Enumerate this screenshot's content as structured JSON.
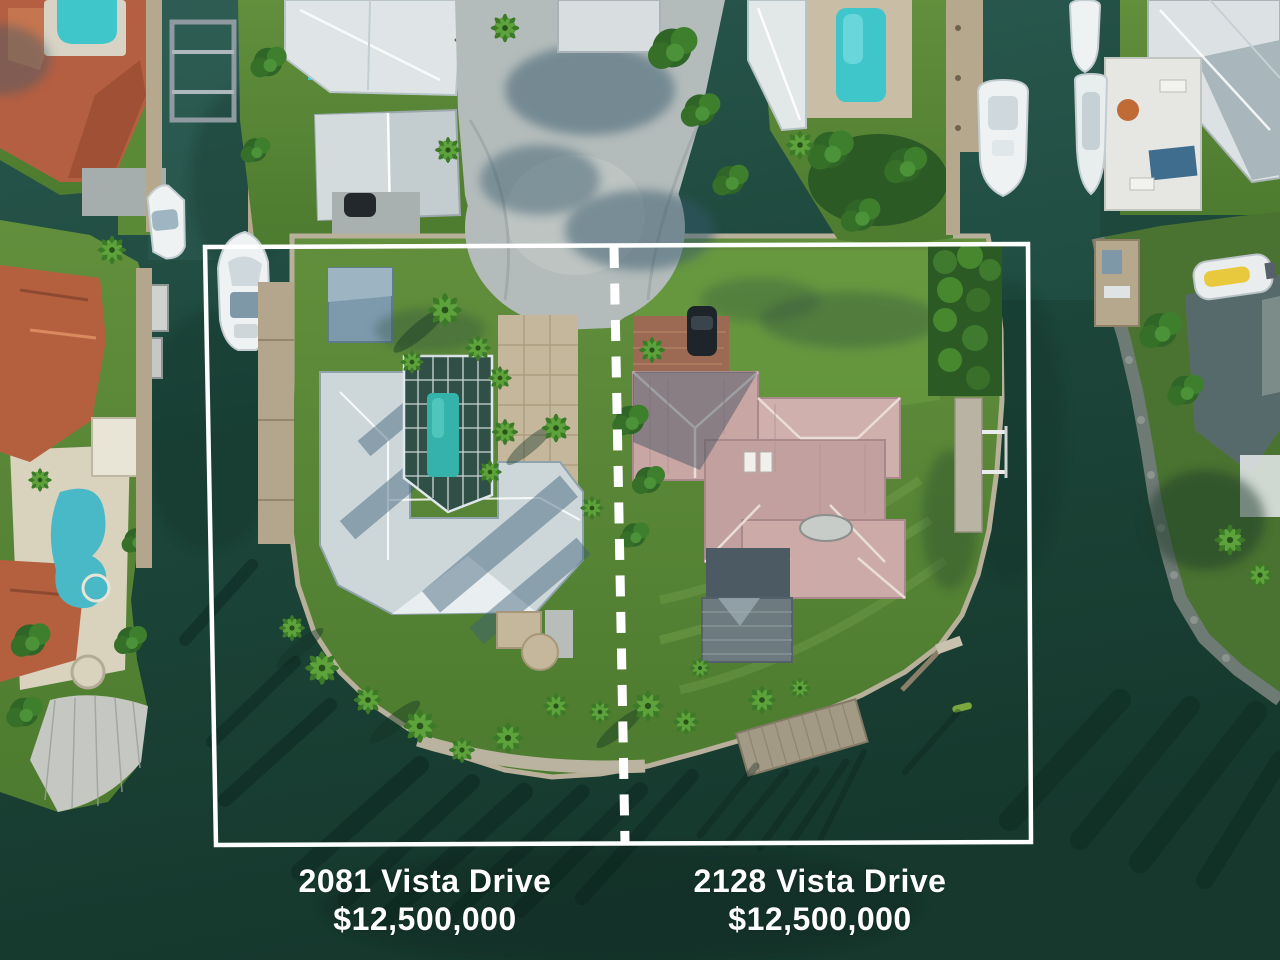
{
  "labels": {
    "left": {
      "address": "2081 Vista Drive",
      "price": "$12,500,000"
    },
    "right": {
      "address": "2128 Vista Drive",
      "price": "$12,500,000"
    }
  },
  "palette": {
    "overlay_white": "#ffffff",
    "water_deep": "#1d473b",
    "grass_green": "#5d8f3b",
    "left_house_roof": "#cdd7da",
    "right_house_roof": "#c7a6a4",
    "pool_cyan": "#3fc6cb",
    "terracotta_roof": "#b45f42"
  }
}
